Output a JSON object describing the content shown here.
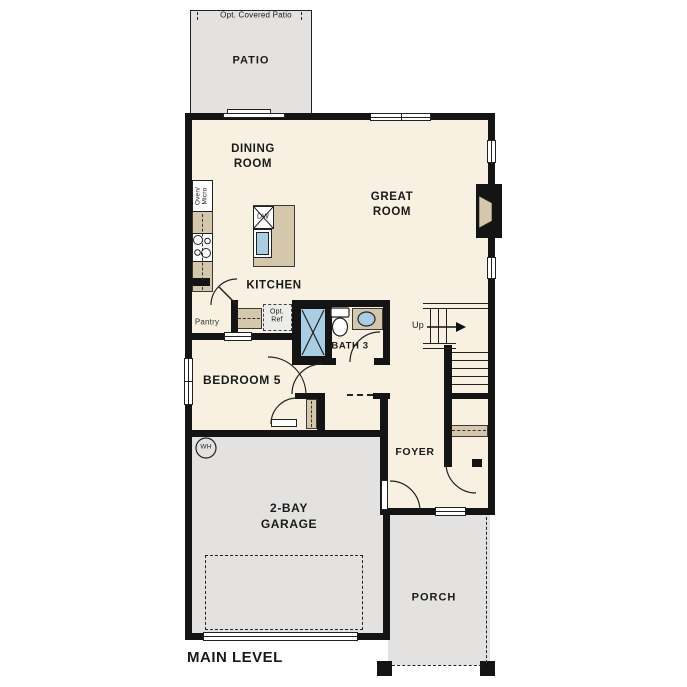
{
  "colors": {
    "floor": "#f8f0e1",
    "ext": "#e3e2e0",
    "counter": "#d5c7ab",
    "fixture": "#a9cee4",
    "wall": "#141414",
    "line": "#222222",
    "text": "#1a1a1a"
  },
  "labels": {
    "opt_covered_patio": "Opt. Covered Patio",
    "patio": "PATIO",
    "dining_room": "DINING\nROOM",
    "great_room": "GREAT\nROOM",
    "kitchen": "KITCHEN",
    "oven_micro": "Oven/\nMicro",
    "dw": "DW",
    "pantry": "Pantry",
    "opt_ref": "Opt.\nRef",
    "bath3": "BATH 3",
    "bedroom5": "BEDROOM 5",
    "up": "Up",
    "foyer": "FOYER",
    "wh": "WH",
    "garage": "2-BAY\nGARAGE",
    "porch": "PORCH",
    "main_level": "MAIN LEVEL"
  }
}
